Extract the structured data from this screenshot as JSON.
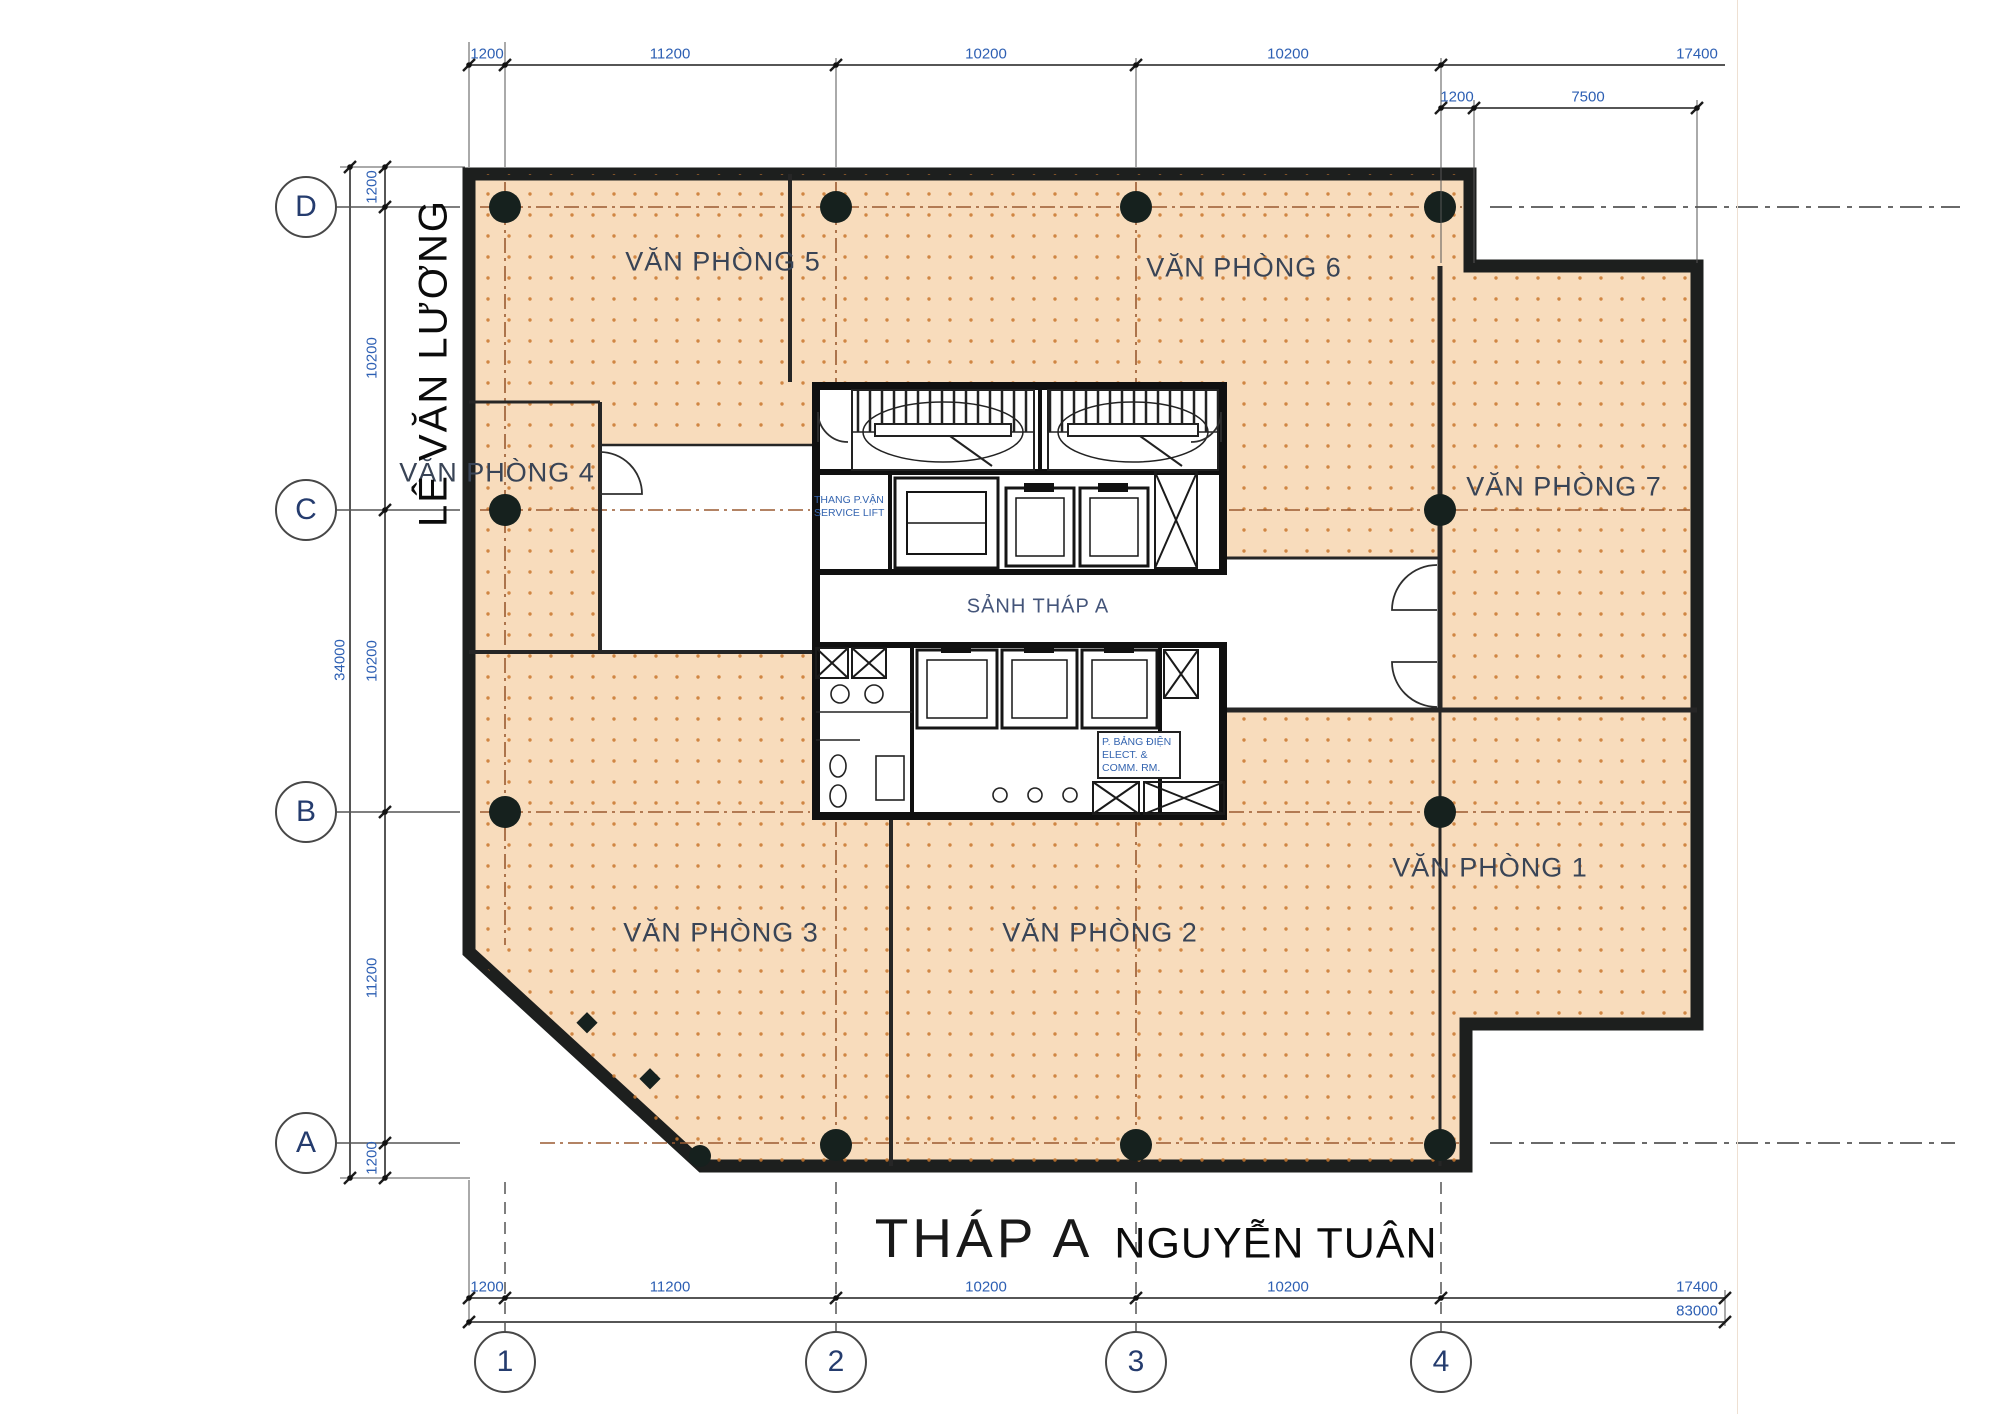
{
  "title": "THÁP A",
  "streets": {
    "left": "LÊ VĂN LƯƠNG",
    "bottom": "NGUYỄN TUÂN"
  },
  "rooms": [
    {
      "label": "VĂN PHÒNG 1"
    },
    {
      "label": "VĂN PHÒNG 2"
    },
    {
      "label": "VĂN PHÒNG 3"
    },
    {
      "label": "VĂN PHÒNG 4"
    },
    {
      "label": "VĂN PHÒNG 5"
    },
    {
      "label": "VĂN PHÒNG 6"
    },
    {
      "label": "VĂN PHÒNG 7"
    }
  ],
  "lobby": "SẢNH THÁP A",
  "core": {
    "service_lift_l1": "THANG P.VẬN",
    "service_lift_l2": "SERVICE LIFT",
    "elect_l1": "P. BẢNG ĐIỆN",
    "elect_l2": "ELECT. &",
    "elect_l3": "COMM. RM."
  },
  "grid": {
    "cols": [
      "1",
      "2",
      "3",
      "4"
    ],
    "rows": [
      "D",
      "C",
      "B",
      "A"
    ]
  },
  "dims": {
    "top": [
      "1200",
      "11200",
      "10200",
      "10200",
      "17400"
    ],
    "top_inset": [
      "1200",
      "7500"
    ],
    "left": [
      "1200",
      "10200",
      "10200",
      "11200",
      "1200"
    ],
    "left_total": "34000",
    "bottom": [
      "1200",
      "11200",
      "10200",
      "10200",
      "17400"
    ],
    "bottom_total": "83000"
  },
  "colors": {
    "floor_fill": "#f8dcbc",
    "dot": "#c9772e",
    "wall": "#1d1f1e",
    "dim_text": "#2d5fb3",
    "grid_dash": "#9a5a30"
  }
}
